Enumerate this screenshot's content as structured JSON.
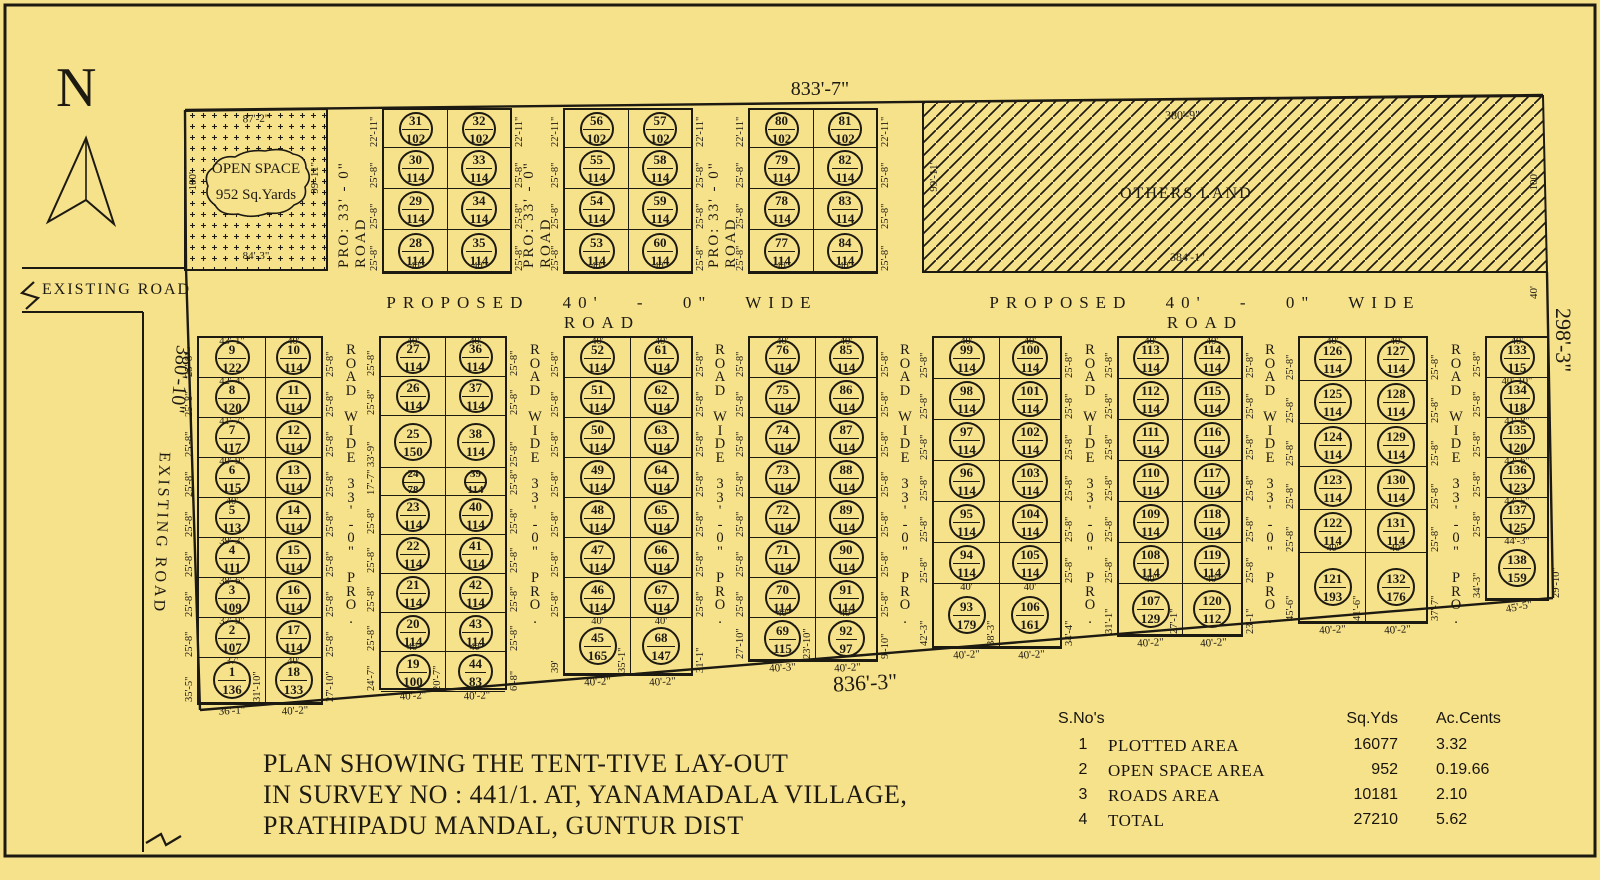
{
  "colors": {
    "background": "#f7e28c",
    "line": "#1d1a12"
  },
  "north": {
    "label": "N"
  },
  "boundary_dims": {
    "top": "833'-7\"",
    "bottom": "836'-3\"",
    "left": "380'-10\"",
    "right": "298'-3\"",
    "right_road_width": "40'"
  },
  "existing_road": {
    "label_horizontal": "EXISTING ROAD",
    "label_vertical": "EXISTING ROAD"
  },
  "open_space": {
    "line1": "OPEN SPACE",
    "line2": "952 Sq.Yards",
    "dim_top": "87'-2\"",
    "dim_bottom": "84'-3\"",
    "dim_left": "100'",
    "dim_right": "99'-11\""
  },
  "others_land": {
    "label": "OTHERS LAND",
    "dim_top": "380'-9\"",
    "dim_bottom": "384'-1\"",
    "dim_left": "99'-11\"",
    "dim_right": "100'"
  },
  "road_labels": {
    "proposed_display": "PROPOSED  40' - 0\"  WIDE  ROAD",
    "top_vertical": "PRO: 33' - 0\" ROAD",
    "bottom_vertical_label": "PRO. 33'-0\" WIDE ROAD",
    "bottom_vertical_words": [
      "ROAD",
      "WIDE",
      "33'-0\"",
      "PRO."
    ]
  },
  "top_blocks": [
    {
      "rows": [
        {
          "cells": [
            [
              "31",
              "102"
            ],
            [
              "32",
              "102"
            ]
          ],
          "side": "22'-11\""
        },
        {
          "cells": [
            [
              "30",
              "114"
            ],
            [
              "33",
              "114"
            ]
          ],
          "side": "25'-8\""
        },
        {
          "cells": [
            [
              "29",
              "114"
            ],
            [
              "34",
              "114"
            ]
          ],
          "side": "25'-8\""
        },
        {
          "cells": [
            [
              "28",
              "114"
            ],
            [
              "35",
              "114"
            ]
          ],
          "side": "25'-8\""
        }
      ],
      "bottom": [
        "40'",
        "40'"
      ]
    },
    {
      "rows": [
        {
          "cells": [
            [
              "56",
              "102"
            ],
            [
              "57",
              "102"
            ]
          ],
          "side": "22'-11\""
        },
        {
          "cells": [
            [
              "55",
              "114"
            ],
            [
              "58",
              "114"
            ]
          ],
          "side": "25'-8\""
        },
        {
          "cells": [
            [
              "54",
              "114"
            ],
            [
              "59",
              "114"
            ]
          ],
          "side": "25'-8\""
        },
        {
          "cells": [
            [
              "53",
              "114"
            ],
            [
              "60",
              "114"
            ]
          ],
          "side": "25'-8\""
        }
      ],
      "bottom": [
        "40'",
        "40'"
      ]
    },
    {
      "rows": [
        {
          "cells": [
            [
              "80",
              "102"
            ],
            [
              "81",
              "102"
            ]
          ],
          "side": "22'-11\""
        },
        {
          "cells": [
            [
              "79",
              "114"
            ],
            [
              "82",
              "114"
            ]
          ],
          "side": "25'-8\""
        },
        {
          "cells": [
            [
              "78",
              "114"
            ],
            [
              "83",
              "114"
            ]
          ],
          "side": "25'-8\""
        },
        {
          "cells": [
            [
              "77",
              "114"
            ],
            [
              "84",
              "114"
            ]
          ],
          "side": "25'-8\""
        }
      ],
      "bottom": [
        "40'",
        "40'"
      ]
    }
  ],
  "bottom_blocks": [
    {
      "rows": [
        {
          "l": [
            "9",
            "122"
          ],
          "r": [
            "10",
            "114"
          ],
          "ltop": "43'-1\"",
          "rtop": "40'",
          "ldim": "25'-8\"",
          "rdim": "25'-8\""
        },
        {
          "l": [
            "8",
            "120"
          ],
          "r": [
            "11",
            "114"
          ],
          "ltop": "42'-4\"",
          "ldim": "25'-8\"",
          "rdim": "25'-8\""
        },
        {
          "l": [
            "7",
            "117"
          ],
          "r": [
            "12",
            "114"
          ],
          "ltop": "41'-7\"",
          "ldim": "25'-8\"",
          "rdim": "25'-8\""
        },
        {
          "l": [
            "6",
            "115"
          ],
          "r": [
            "13",
            "114"
          ],
          "ltop": "40'-9\"",
          "ldim": "25'-8\"",
          "rdim": "25'-8\""
        },
        {
          "l": [
            "5",
            "113"
          ],
          "r": [
            "14",
            "114"
          ],
          "ltop": "40'",
          "ldim": "25'-8\"",
          "rdim": "25'-8\""
        },
        {
          "l": [
            "4",
            "111"
          ],
          "r": [
            "15",
            "114"
          ],
          "ltop": "39'-3\"",
          "ldim": "25'-8\"",
          "rdim": "25'-8\""
        },
        {
          "l": [
            "3",
            "109"
          ],
          "r": [
            "16",
            "114"
          ],
          "ltop": "38'-6\"",
          "ldim": "25'-8\"",
          "rdim": "25'-8\""
        },
        {
          "l": [
            "2",
            "107"
          ],
          "r": [
            "17",
            "114"
          ],
          "ltop": "37'-9\"",
          "ldim": "25'-8\"",
          "rdim": "25'-8\""
        },
        {
          "l": [
            "1",
            "136"
          ],
          "r": [
            "18",
            "133"
          ],
          "ltop": "37'",
          "rtop": "40'",
          "ldim": "35'-5\"",
          "mdim": "31'-10\"",
          "rdim": "27'-10\"",
          "lbot": "36'-1\"",
          "rbot": "40'-2\""
        }
      ]
    },
    {
      "rows": [
        {
          "l": [
            "27",
            "114"
          ],
          "r": [
            "36",
            "114"
          ],
          "ltop": "40'",
          "rtop": "40'",
          "ldim": "25'-8\"",
          "rdim": "25'-8\""
        },
        {
          "l": [
            "26",
            "114"
          ],
          "r": [
            "37",
            "114"
          ],
          "ldim": "25'-8\"",
          "rdim": "25'-8\""
        },
        {
          "l": [
            "25",
            "150"
          ],
          "r": [
            "38",
            "114"
          ],
          "ldim": "33'-9\"",
          "rdim": "25'-8\""
        },
        {
          "l": [
            "24",
            "78"
          ],
          "r": [
            "39",
            "114"
          ],
          "ldim": "17'-7\"",
          "rdim": "25'-8\""
        },
        {
          "l": [
            "23",
            "114"
          ],
          "r": [
            "40",
            "114"
          ],
          "ldim": "25'-8\"",
          "rdim": "25'-8\""
        },
        {
          "l": [
            "22",
            "114"
          ],
          "r": [
            "41",
            "114"
          ],
          "ldim": "25'-8\"",
          "rdim": "25'-8\""
        },
        {
          "l": [
            "21",
            "114"
          ],
          "r": [
            "42",
            "114"
          ],
          "ldim": "25'-8\"",
          "rdim": "25'-8\""
        },
        {
          "l": [
            "20",
            "114"
          ],
          "r": [
            "43",
            "114"
          ],
          "ldim": "25'-8\"",
          "rdim": "25'-8\"",
          "lbotin": "40'",
          "rbotin": "40'"
        },
        {
          "l": [
            "19",
            "100"
          ],
          "r": [
            "44",
            "83"
          ],
          "ldim": "24'-7\"",
          "mdim": "20'-7\"",
          "rdim": "6'-8\"",
          "lbot": "40'-2\"",
          "rbot": "40'-2\""
        }
      ]
    },
    {
      "rows": [
        {
          "l": [
            "52",
            "114"
          ],
          "r": [
            "61",
            "114"
          ],
          "ltop": "40'",
          "rtop": "40'",
          "ldim": "25'-8\"",
          "rdim": "25'-8\""
        },
        {
          "l": [
            "51",
            "114"
          ],
          "r": [
            "62",
            "114"
          ],
          "ldim": "25'-8\"",
          "rdim": "25'-8\""
        },
        {
          "l": [
            "50",
            "114"
          ],
          "r": [
            "63",
            "114"
          ],
          "ldim": "25'-8\"",
          "rdim": "25'-8\""
        },
        {
          "l": [
            "49",
            "114"
          ],
          "r": [
            "64",
            "114"
          ],
          "ldim": "25'-8\"",
          "rdim": "25'-8\""
        },
        {
          "l": [
            "48",
            "114"
          ],
          "r": [
            "65",
            "114"
          ],
          "ldim": "25'-8\"",
          "rdim": "25'-8\""
        },
        {
          "l": [
            "47",
            "114"
          ],
          "r": [
            "66",
            "114"
          ],
          "ldim": "25'-8\"",
          "rdim": "25'-8\""
        },
        {
          "l": [
            "46",
            "114"
          ],
          "r": [
            "67",
            "114"
          ],
          "ldim": "25'-8\"",
          "rdim": "25'-8\""
        },
        {
          "l": [
            "45",
            "165"
          ],
          "r": [
            "68",
            "147"
          ],
          "ltop": "40'",
          "rtop": "40'",
          "ldim": "39'",
          "mdim": "35'-1\"",
          "rdim": "31'-1\"",
          "lbot": "40'-2\"",
          "rbot": "40'-2\""
        }
      ]
    },
    {
      "rows": [
        {
          "l": [
            "76",
            "114"
          ],
          "r": [
            "85",
            "114"
          ],
          "ltop": "40'",
          "rtop": "40'",
          "ldim": "25'-8\"",
          "rdim": "25'-8\""
        },
        {
          "l": [
            "75",
            "114"
          ],
          "r": [
            "86",
            "114"
          ],
          "ldim": "25'-8\"",
          "rdim": "25'-8\""
        },
        {
          "l": [
            "74",
            "114"
          ],
          "r": [
            "87",
            "114"
          ],
          "ldim": "25'-8\"",
          "rdim": "25'-8\""
        },
        {
          "l": [
            "73",
            "114"
          ],
          "r": [
            "88",
            "114"
          ],
          "ldim": "25'-8\"",
          "rdim": "25'-8\""
        },
        {
          "l": [
            "72",
            "114"
          ],
          "r": [
            "89",
            "114"
          ],
          "ldim": "25'-8\"",
          "rdim": "25'-8\""
        },
        {
          "l": [
            "71",
            "114"
          ],
          "r": [
            "90",
            "114"
          ],
          "ldim": "25'-8\"",
          "rdim": "25'-8\""
        },
        {
          "l": [
            "70",
            "114"
          ],
          "r": [
            "91",
            "114"
          ],
          "ldim": "25'-8\"",
          "rdim": "25'-8\"",
          "lbotin": "40'",
          "rbotin": "40'"
        },
        {
          "l": [
            "69",
            "115"
          ],
          "r": [
            "92",
            "97"
          ],
          "ldim": "27'-10\"",
          "mdim": "23'-10\"",
          "rdim": "9'-10\"",
          "lbot": "40'-3\"",
          "rbot": "40'-2\""
        }
      ]
    },
    {
      "rows": [
        {
          "l": [
            "99",
            "114"
          ],
          "r": [
            "100",
            "114"
          ],
          "ltop": "40'",
          "rtop": "40'",
          "ldim": "25'-8\"",
          "rdim": "25'-8\""
        },
        {
          "l": [
            "98",
            "114"
          ],
          "r": [
            "101",
            "114"
          ],
          "ldim": "25'-8\"",
          "rdim": "25'-8\""
        },
        {
          "l": [
            "97",
            "114"
          ],
          "r": [
            "102",
            "114"
          ],
          "ldim": "25'-8\"",
          "rdim": "25'-8\""
        },
        {
          "l": [
            "96",
            "114"
          ],
          "r": [
            "103",
            "114"
          ],
          "ldim": "25'-8\"",
          "rdim": "25'-8\""
        },
        {
          "l": [
            "95",
            "114"
          ],
          "r": [
            "104",
            "114"
          ],
          "ldim": "25'-8\"",
          "rdim": "25'-8\""
        },
        {
          "l": [
            "94",
            "114"
          ],
          "r": [
            "105",
            "114"
          ],
          "ldim": "25'-8\"",
          "rdim": "25'-8\""
        },
        {
          "l": [
            "93",
            "179"
          ],
          "r": [
            "106",
            "161"
          ],
          "ltop": "40'",
          "rtop": "40'",
          "ldim": "42'-3\"",
          "mdim": "38'-3\"",
          "rdim": "34'-4\"",
          "lbot": "40'-2\"",
          "rbot": "40'-2\""
        }
      ]
    },
    {
      "rows": [
        {
          "l": [
            "113",
            "114"
          ],
          "r": [
            "114",
            "114"
          ],
          "ltop": "40'",
          "rtop": "40'",
          "ldim": "25'-8\"",
          "rdim": "25'-8\""
        },
        {
          "l": [
            "112",
            "114"
          ],
          "r": [
            "115",
            "114"
          ],
          "ldim": "25'-8\"",
          "rdim": "25'-8\""
        },
        {
          "l": [
            "111",
            "114"
          ],
          "r": [
            "116",
            "114"
          ],
          "ldim": "25'-8\"",
          "rdim": "25'-8\""
        },
        {
          "l": [
            "110",
            "114"
          ],
          "r": [
            "117",
            "114"
          ],
          "ldim": "25'-8\"",
          "rdim": "25'-8\""
        },
        {
          "l": [
            "109",
            "114"
          ],
          "r": [
            "118",
            "114"
          ],
          "ldim": "25'-8\"",
          "rdim": "25'-8\""
        },
        {
          "l": [
            "108",
            "114"
          ],
          "r": [
            "119",
            "114"
          ],
          "ldim": "25'-8\"",
          "rdim": "25'-8\"",
          "lbotin": "40'",
          "rbotin": "40'"
        },
        {
          "l": [
            "107",
            "129"
          ],
          "r": [
            "120",
            "112"
          ],
          "ldim": "31'-1\"",
          "mdim": "27'-1\"",
          "rdim": "23'-1\"",
          "lbot": "40'-2\"",
          "rbot": "40'-2\""
        }
      ]
    },
    {
      "rows": [
        {
          "l": [
            "126",
            "114"
          ],
          "r": [
            "127",
            "114"
          ],
          "ltop": "40'",
          "rtop": "40'",
          "ldim": "25'-8\"",
          "rdim": "25'-8\""
        },
        {
          "l": [
            "125",
            "114"
          ],
          "r": [
            "128",
            "114"
          ],
          "ldim": "25'-8\"",
          "rdim": "25'-8\""
        },
        {
          "l": [
            "124",
            "114"
          ],
          "r": [
            "129",
            "114"
          ],
          "ldim": "25'-8\"",
          "rdim": "25'-8\""
        },
        {
          "l": [
            "123",
            "114"
          ],
          "r": [
            "130",
            "114"
          ],
          "ldim": "25'-8\"",
          "rdim": "25'-8\""
        },
        {
          "l": [
            "122",
            "114"
          ],
          "r": [
            "131",
            "114"
          ],
          "ldim": "25'-8\"",
          "rdim": "25'-8\"",
          "lbotin": "40'",
          "rbotin": "40'"
        },
        {
          "l": [
            "121",
            "193"
          ],
          "r": [
            "132",
            "176"
          ],
          "ldim": "45'-6\"",
          "mdim": "41'-6\"",
          "rdim": "37'-7\"",
          "lbot": "40'-2\"",
          "rbot": "40'-2\""
        }
      ]
    },
    {
      "rows": [
        {
          "l": [
            "133",
            "115"
          ],
          "ltop": "40'",
          "ldim": "25'-8\""
        },
        {
          "l": [
            "134",
            "118"
          ],
          "ltop": "40'-10\"",
          "ldim": "25'-8\""
        },
        {
          "l": [
            "135",
            "120"
          ],
          "ltop": "41'-8\"",
          "ldim": "25'-8\""
        },
        {
          "l": [
            "136",
            "123"
          ],
          "ltop": "42'-6\"",
          "ldim": "25'-8\""
        },
        {
          "l": [
            "137",
            "125"
          ],
          "ltop": "43'-5\"",
          "ldim": "25'-8\""
        },
        {
          "l": [
            "138",
            "159"
          ],
          "ltop": "44'-3\"",
          "ldim": "34'-3\"",
          "rdim": "29'-10\"",
          "lbot": "45'-5\""
        }
      ]
    }
  ],
  "title": {
    "lines": [
      "PLAN SHOWING THE TENT-TIVE LAY-OUT",
      "IN SURVEY NO : 441/1. AT, YANAMADALA VILLAGE,",
      "PRATHIPADU MANDAL, GUNTUR DIST"
    ]
  },
  "area_table": {
    "header_sno": "S.No's",
    "header_sqyds": "Sq.Yds",
    "header_accents": "Ac.Cents",
    "rows": [
      {
        "sno": "1",
        "name": "PLOTTED AREA",
        "sqyds": "16077",
        "accents": "3.32"
      },
      {
        "sno": "2",
        "name": "OPEN SPACE AREA",
        "sqyds": "952",
        "accents": "0.19.66"
      },
      {
        "sno": "3",
        "name": "ROADS AREA",
        "sqyds": "10181",
        "accents": "2.10"
      },
      {
        "sno": "4",
        "name": "TOTAL",
        "sqyds": "27210",
        "accents": "5.62"
      }
    ]
  }
}
